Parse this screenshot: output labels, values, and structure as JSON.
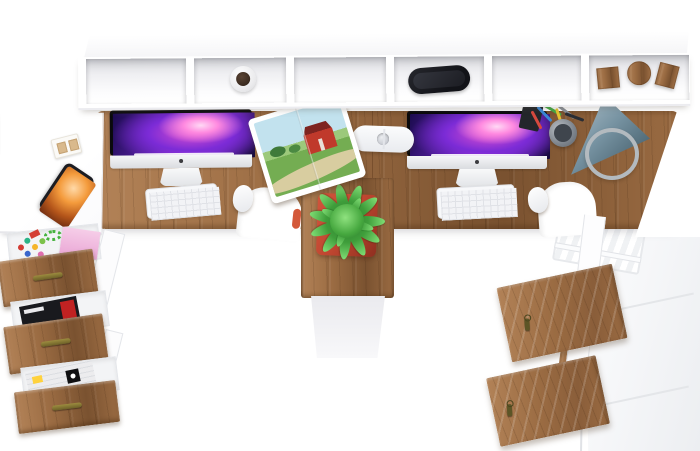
{
  "scene": {
    "name": "double-workstation-top-view",
    "description": "Top-down 3D product render of a white and oak two-person computer desk set",
    "background": "#ffffff"
  },
  "colors": {
    "bg": "#ffffff",
    "wood_hi": "#b28257",
    "wood_mid": "#9a6b42",
    "wood_lo": "#7a5230",
    "panel_shade": "#ececef",
    "panel_line": "#e3e5e9",
    "screen_deep": "#1b0b4e",
    "screen_violet": "#7b2bd6",
    "screen_magenta": "#d84fd0",
    "chin_silver": "#dadce0",
    "keyboard_white": "#f7f8fa",
    "pot_red": "#bf4630",
    "plant_green": "#3f9e3b",
    "plant_green_dark": "#2b7a2c",
    "lamp_steel": "#7793a2",
    "lamp_ring": "#b3babf",
    "phone_screen": "#f49b3c",
    "handle_brass": "#6d6128",
    "mug_inside": "#3a2a1f",
    "barn_red": "#c0392b",
    "sky": "#c2e2ee",
    "grass": "#74ad52"
  },
  "shelf": {
    "cubby_contents": [
      "magazine-stack",
      "mug",
      "book-row",
      "headphones",
      "book-stack",
      "wooden-blocks"
    ],
    "magazine_stack_colors": [
      "#f3f3f1",
      "#ffd84d",
      "#ef8f3a",
      "#9fd4f0",
      "#ffffff",
      "#e8552f",
      "#f2a2c4",
      "#cfd8e8"
    ],
    "book_row_colors": [
      "#6e1f2e",
      "#14325f",
      "#2f6fb0",
      "#17a3ae",
      "#214d2b",
      "#8e2222",
      "#e9e3d2",
      "#1693a6"
    ],
    "book_stack_colors": [
      "#2d5f8a",
      "#cfd6de",
      "#1c3f66",
      "#e8e8ea",
      "#2b77a8",
      "#14243d",
      "#d9dde2"
    ]
  },
  "desk": {
    "workstations": 2,
    "left_items": [
      "imac",
      "keyboard",
      "mouse",
      "open-barn-magazine"
    ],
    "right_items": [
      "imac",
      "keyboard",
      "mouse",
      "pen-cup",
      "notebook",
      "cone-lamp"
    ],
    "shared_items": [
      "power-strip"
    ],
    "power_strip_sockets": 4,
    "pen_colors": [
      "#d6493f",
      "#3a87d6",
      "#43a843",
      "#e4c02f",
      "#8a8f96",
      "#2a2d33"
    ]
  },
  "side_table_items": [
    "smartphone",
    "card-holder"
  ],
  "drawer_unit": {
    "drawer_count": 3,
    "contents": [
      "candy-and-sticky-notes",
      "magazines",
      "newspapers"
    ],
    "candy_colors": [
      "#d23b33",
      "#2bb387",
      "#f5b52a",
      "#3a66cc",
      "#e06fb0",
      "#7cc24a"
    ]
  },
  "pedestal": {
    "items": [
      "potted-plant"
    ]
  },
  "cabinet": {
    "open_doors": 2,
    "door_keys": 2,
    "accessories": [
      "paper-trolley"
    ]
  }
}
